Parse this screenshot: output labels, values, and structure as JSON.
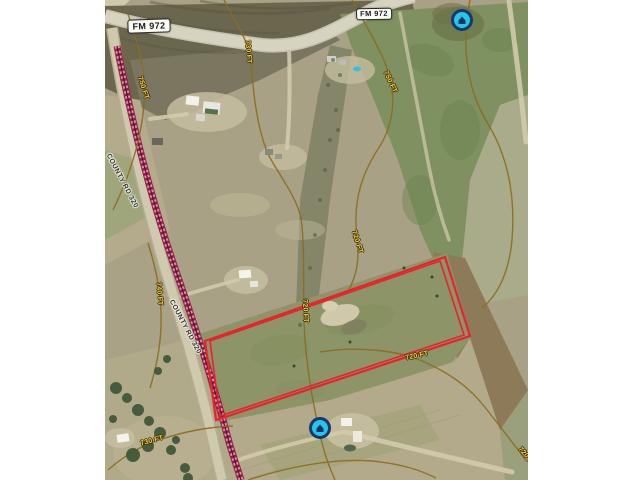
{
  "map": {
    "road_badges": [
      {
        "id": "fm-972-west",
        "text": "FM 972"
      },
      {
        "id": "fm-972-east",
        "text": "FM 972"
      },
      {
        "id": "county-rd-320-north",
        "text": "COUNTY RD 320"
      },
      {
        "id": "county-rd-320-south",
        "text": "COUNTY RD 320"
      }
    ],
    "contour_labels": [
      {
        "text": "730 FT"
      },
      {
        "text": "750 FT"
      },
      {
        "text": "750 FT"
      },
      {
        "text": "740 FT"
      },
      {
        "text": "720 FT"
      },
      {
        "text": "720 FT"
      },
      {
        "text": "720 FT"
      },
      {
        "text": "730 FT"
      },
      {
        "text": "720 FT"
      }
    ],
    "parcel": {
      "outline_color": "#e8232d",
      "outer_corners": [
        [
          205,
          341
        ],
        [
          445,
          257
        ],
        [
          470,
          336
        ],
        [
          216,
          420
        ]
      ],
      "inner_corners": [
        [
          210,
          341
        ],
        [
          440,
          261
        ],
        [
          464,
          335
        ],
        [
          220,
          416
        ]
      ]
    },
    "markers": [
      {
        "id": "marker-north",
        "x": 462,
        "y": 20,
        "fill": "#29c5e6",
        "ring": "#16386f"
      },
      {
        "id": "marker-south",
        "x": 320,
        "y": 428,
        "fill": "#29c5e6",
        "ring": "#16386f"
      }
    ],
    "colors": {
      "parcel_outline": "#e8232d",
      "contour_line": "#8a6d1f",
      "contour_label_text": "#f2cf4a",
      "railroad": "#8e2346",
      "road_badge_bg": "#fdfdf8",
      "marker_fill": "#29c5e6"
    }
  }
}
